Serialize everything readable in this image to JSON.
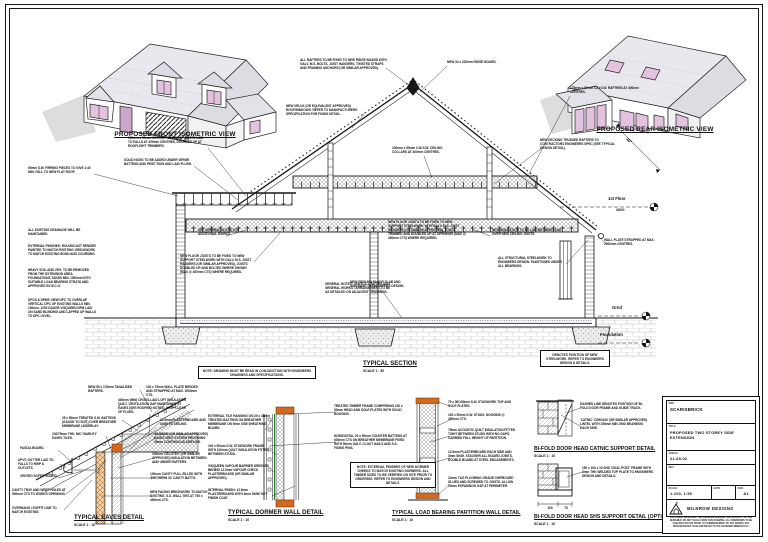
{
  "colors": {
    "line": "#161616",
    "brick_orange": "#d2691e",
    "glass_pink": "#e3c2e0",
    "dpm_blue": "#4646a8",
    "roof_grey": "#e8e8ee"
  },
  "iso": {
    "front_label": "PROPOSED FRONT ISOMETRIC VIEW",
    "rear_label": "PROPOSED REAR ISOMETRIC VIEW"
  },
  "section": {
    "title": "TYPICAL SECTION",
    "scale": "SCALE 1 : 50"
  },
  "levels": {
    "first_floor": "1st Floor",
    "first_floor_value": "2600",
    "ground": "Grnd",
    "foundation": "Foundation"
  },
  "details": {
    "eaves": {
      "title": "TYPICAL EAVES DETAIL",
      "scale": "SCALE 1 : 10"
    },
    "dormer": {
      "title": "TYPICAL DORMER WALL DETAIL",
      "scale": "SCALE 1 : 10"
    },
    "partition": {
      "title": "TYPICAL LOAD BEARING PARTITION WALL DETAIL",
      "scale": "SCALE 1 : 10"
    },
    "catnic": {
      "title": "BI-FOLD DOOR HEAD CATNIC SUPPORT DETAIL",
      "scale": "SCALE 1 : 10"
    },
    "shs": {
      "title": "BI-FOLD DOOR HEAD SHS SUPPORT DETAIL (OPTION 2)",
      "scale": "SCALE 1 : 10"
    }
  },
  "dims": {
    "shs_a": "100",
    "shs_b": "75"
  },
  "notes": {
    "pitch": "40°",
    "ridge_fix": "ALL RAFTERS TO BE FIXED TO NEW RIDGE BOARD WITH GALV. M.S. BOLTS, JOIST HANGERS, TWISTED STRAPS AND FRAMING ANCHORS (OR SIMILAR APPROVED).",
    "ridge_board": "NEW 32 x 225mm RIDGE BOARD.",
    "rafters": "175mm x 50mm C24 S.W. RAFTERS AT 400mm CENTRES.",
    "trusses": "NEW DECKING TRUSSED RAFTERS TO CONTRACTORS ENGINEERS SPEC (SEE TYPICAL DESIGN DETAIL).",
    "velux": "NEW VELUX (OR EQUIVALENT APPROVED) ROOFWINDOWS. REFER TO MANUFACTURERS SPECIFICATION FOR FIXING DETAIL.",
    "verge_nogs": "SOLID NOGS TO BE ADDED UNDER VERGE BATTENS AND FIRST ROW AND LAID FLUSH.",
    "flat_joists": "150mm x 50mm C24 S.W. FLAT ROOF JOISTS LAID TO FALLS AT 400mm CENTRES, DOUBLED UP AT ROOFLIGHT TRIMMERS.",
    "firring": "50mm S.W. FIRRING PIECES TO GIVE 1:40 MIN. FALL TO NEW FLAT ROOF.",
    "collars": "100mm x 50mm C16 S.W. CEILING COLLARS AT 400mm CENTRES.",
    "drainage": "ALL EXISTING DRAINAGE WILL BE MAINTAINED.",
    "ext_finishes": "EXTERNAL FINISHES: ROUGHCAST RENDER PAINTED TO MATCH EXISTING. BRICKWORK TO MATCH EXISTING BOND AND COURSING.",
    "excavation": "HEAVY SOIL AND VEG. TO BE REMOVED FROM THE EXTENSION AREA. FOUNDATIONS TAKEN MIN. 1000mm INTO SUITABLE LOAD BEARING STRATA AND APPROVED BY B.C.O.",
    "dpc": "DPCS & DPMS: NEW DPC TO OVERLAP VERTICAL DPC OF EXISTING WALLS MIN. 100mm. 1200 GAUGE VISQUEEN DPM LAID ON SAND BLINDING AND LAPPED UP WALLS TO DPC LEVEL.",
    "room_general": "SEE GENERAL NOTES FOR ADDITIONAL WORKS.",
    "joists_left": "NEW FLOOR JOISTS TO BE FIXED TO NEW SUPPORT STEELWORK WITH GALV. M.S. JOIST HANGERS (OR SIMILAR APPROVED), JOISTS DOUBLED UP AND BOLTED WHERE SHOWN (MAX @ 400mm CTS) WHERE REQUIRED.",
    "joists_right": "NEW FLOOR JOISTS TO BE FIXED TO NEW SUPPORT STEELWORK WITH GALV. M.S. JOIST HANGERS (OR SIMILAR APPROVED). JOISTS TRIMMED AND DOUBLED UP AT OPENINGS (MAX @ 400mm CTS) WHERE REQUIRED.",
    "general_sources": "GENERAL NOTES: LINTELS, CAVITIES AND GENERAL WORKS / ARRANGEMENT TO BE AS DETAILED ON ADJACENT DRAWINGS.",
    "floor_insul": "NEW INSULATION TO BE LAID BETWEEN AND OVER NEW CEILING JOISTS.",
    "steelwork": "ALL STRUCTURAL STEELWORK TO ENGINEERS DESIGN. PADSTONES UNDER ALL BEARINGS.",
    "slab": "NEW GROUND FLOOR SLAB AND SUB-BASE TO ENGINEERS DESIGN.",
    "wallplate_strap": "WALL PLATE STRAPPED AT MAX. 2000mm CENTRES.",
    "box_main": "NOTE: DRAWING MUST BE READ IN CONJUNCTION WITH ENGINEERS DRAWINGS AND SPECIFICATIONS.",
    "box_steel": "DENOTES POSITION OF NEW STEELWORK. REFER TO ENGINEERS DESIGN & DETAILS.",
    "box_dormer": "NOTE: EXTERNAL FINISHES OF NEW DORMER CHEEKS TO MATCH EXISTING DORMERS. ALL TIMBER SIZES TO BE VERIFIED ON SITE PRIOR TO ORDERING. REFER TO ENGINEERS DESIGN AND DETAILS.",
    "ea_rafters": "NEW 50 x 175mm TANALISED RAFTERS.",
    "ea_wallplate": "100 x 75mm WALL PLATE BEDDED AND STRAPPED AT MAX. 2000mm CTS.",
    "ea_loft": "400mm (MIN) CROSS-LAID LOFT INSULATION QUILT. VENTILATION GAP MAINTAINED AT EAVES (SEE ROOFING NOTES). KEEP CLEAR OF FLUES.",
    "ea_battens": "25 x 50mm TREATED S.W. BATTENS (GAUGE TO SUIT) OVER BREATHER MEMBRANE UNDERLAY.",
    "ea_pboard": "12.5mm PLASTERBOARD AND SKIM TO CEILING.",
    "ea_tile": "100/75mm THK. M/C 'MARLEY' EAVES TILES.",
    "ea_vent": "'KLOBER' (OR SIMILAR APPROVED) EAVES VENT SYSTEM PROVIDING 25mm CONTINUOUS AIRFLOW.",
    "ea_fascia": "FASCIA BOARD.",
    "ea_gutter": "UPVC GUTTER LAID TO FALLS TO RWP & OUTLETS.",
    "ea_celotex": "100mm 'CELOTEX' (OR SIMILAR APPROVED) INSULATION BETWEEN AND UNDER RAFTERS.",
    "ea_soffit": "VENTED SOFFIT BOARD.",
    "ea_cavity": "100mm CAVITY FULL-FILLED WITH 'DRITHERM 32' CAVITY BATTS.",
    "ea_tray": "CAVITY TRAY AND WEEP HOLES AT 900mm CTS TO WORKS OPENINGS.",
    "ea_brick": "NEW FACING BRICKWORK TO MATCH EXISTING. S.S. WALL TIES AT 750 x 450mm CTS.",
    "ea_overhang": "OVERHANG / SOFFIT LINE TO MATCH EXISTING.",
    "do_cladding": "EXTERNAL TILE HANGING ON 25 x 38mm TREATED BATTENS ON BREATHER MEMBRANE ON 9mm OSB SHEATHING BOARD.",
    "do_studs": "100 x 50mm S.W. STUDWORK FRAME WITH 100mm QUILT INSULATION FITTED BETWEEN STUDS.",
    "do_vapour": "VISQUEEN VAPOUR BARRIER DRESSED BEHIND 12.5mm VAPOUR CHECK PLASTERBOARD (OR SIMILAR APPROVED).",
    "do_lining": "INTERNAL FINISH: 12.5mm PLASTERBOARD WITH 3mm SKIM 'SET' FINISH COAT.",
    "do_frame": "TREATED TIMBER FRAME COMPRISING 100 x 50mm HEAD AND SOLE PLATES WITH SOLID NOGGINS.",
    "do_counterbattens": "HORIZONTAL 25 x 50mm COUNTER BATTENS AT 600mm CTS ON BREATHER MEMBRANE FIXED WITH 50mm GALV. CLOUT NAILS AND S.S. FIXING PINS.",
    "pa_plates": "75 x 50/100mm S.W. STUDWORK TOP AND SOLE PLATES.",
    "pa_studs": "100 x 50mm S.W. STUDS, NOGGINS @ 450mm CTS.",
    "pa_quilt": "75mm ACOUSTIC QUILT INSULATION FITTED TIGHT BETWEEN STUDS WITH NO GAPS, CARRIED FULL HEIGHT OF PARTITION.",
    "pa_boards": "12.5mm PLASTERBOARD EACH SIDE AND 3mm SKIM. STAGGER ALL BOARD JOINTS. DOUBLE BOARD AT STEEL ENCASEMENTS.",
    "pa_flooring": "22mm T&G FLOORING GRADE CHIPBOARD GLUED AND SCREWED TO JOISTS. ALLOW 10mm EXPANSION GAP AT PERIMETER.",
    "bf_dashed": "DASHED LINE DENOTES POSITION OF BI-FOLD DOOR FRAME AND GUIDE TRACK.",
    "bf_catnic": "'CATNIC' CG90/100 (OR SIMILAR APPROVED) LINTEL WITH 150mm MIN. END BEARINGS EACH SIDE.",
    "bf_shs": "150 x 100 x 10 SHS 'GOAL POST' FRAME WITH 8mm THK WELDED TOP PLATE TO ENGINEERS DESIGN AND DETAILS."
  },
  "title_block": {
    "site_label": "SITE",
    "site": "SCARISBRICK",
    "title_label": "TITLE",
    "title": "PROPOSED TWO STOREY SIDE EXTENSION",
    "job_label": "JOB No",
    "job": "21-69-02",
    "rev_label": "REV",
    "scale_label": "SCALE",
    "scale": "1:100, 1:50",
    "date_label": "DATE",
    "date": "",
    "size_label": "SIZE",
    "size": "A1",
    "company": "MILNROW DESIGNS",
    "disclaimer": "COPYRIGHT RESERVED. THIS DRAWING REMAINS THE PROPERTY OF THE DESIGNER. DO NOT SCALE FROM THIS DRAWING. ALL DIMENSIONS TO BE CHECKED ON SITE PRIOR TO COMMENCEMENT OF ANY WORKS. ANY DISCREPANCIES TO BE REPORTED TO THE DESIGNER IMMEDIATELY."
  }
}
